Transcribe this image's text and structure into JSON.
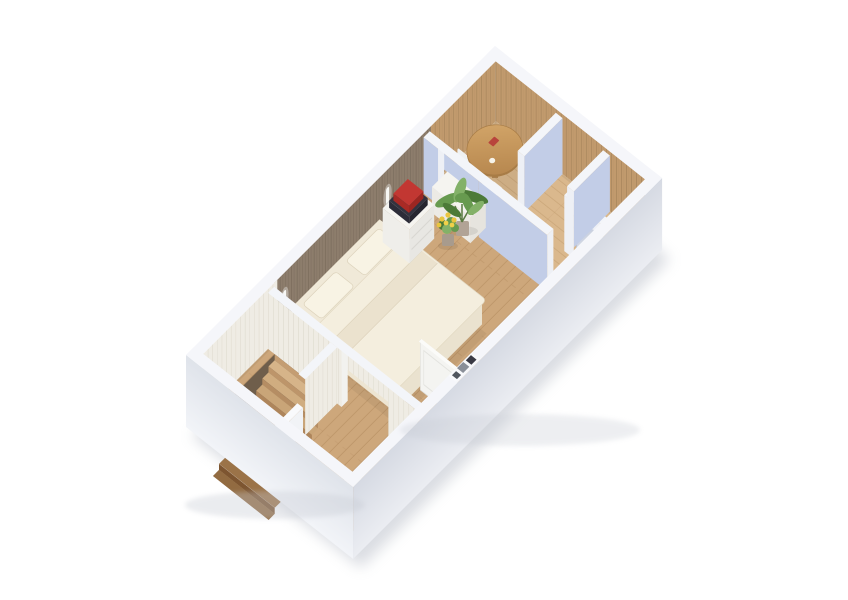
{
  "scene": {
    "type": "isometric-3d-floor-plan",
    "style": "dollhouse cutaway architectural render on white background",
    "rooms": [
      {
        "id": "bedroom",
        "label": "Bedroom",
        "floor": "light oak plank flooring",
        "accent_wall": "brown wood paneling"
      },
      {
        "id": "dining-nook",
        "label": "Dining nook",
        "floor": "oak plank flooring",
        "accent_wall": "natural oak vertical paneling"
      },
      {
        "id": "hallway",
        "label": "Hallway / entry",
        "floor": "diagonal oak planks"
      },
      {
        "id": "stair-hall",
        "label": "Stair hall",
        "floor": "oak plank flooring"
      }
    ],
    "furniture": [
      {
        "id": "double-bed",
        "label": "Double bed with cream duvet, folded throw and two pillows",
        "room": "bedroom"
      },
      {
        "id": "dresser",
        "label": "White bedside dresser with stacked red and dark books on top",
        "room": "bedroom"
      },
      {
        "id": "nightstand",
        "label": "White nightstand",
        "room": "bedroom"
      },
      {
        "id": "wall-sconces",
        "label": "Two white wall sconces on brown paneled wall",
        "room": "bedroom"
      },
      {
        "id": "plant-tall",
        "label": "Tall green potted plant",
        "room": "bedroom"
      },
      {
        "id": "plant-yellow",
        "label": "Small potted plant with yellow flowers",
        "room": "bedroom"
      },
      {
        "id": "round-table",
        "label": "Round wooden dining table with two chairs",
        "room": "dining-nook"
      },
      {
        "id": "service-counter",
        "label": "White counter in pass-through opening",
        "room": "dining-nook"
      },
      {
        "id": "staircase",
        "label": "Wooden staircase descending below",
        "room": "stair-hall"
      },
      {
        "id": "stair-railing",
        "label": "White stair railing and cream knee wall",
        "room": "stair-hall"
      },
      {
        "id": "open-door",
        "label": "Open white interior door",
        "room": "bedroom"
      },
      {
        "id": "blue-door",
        "label": "Blue-grey interior door in white partition",
        "room": "hallway"
      },
      {
        "id": "wall-top-decor",
        "label": "Small dark objects resting on cut wall top",
        "room": "bedroom"
      }
    ],
    "walls": {
      "exterior": "white cutaway walls",
      "partitions": "light periwinkle-blue walls with white caps",
      "stairwell": "cream vertical paneling"
    }
  },
  "colors": {
    "bg": "#ffffff",
    "shadow": "#aeb4c0",
    "ext_top": "#f5f6fa",
    "ext_sw_light": "#f2f4f8",
    "ext_sw_dark": "#dfe3ea",
    "ext_se_light": "#ebedf2",
    "ext_se_dark": "#d6dae3",
    "oak_base": "#c19a6d",
    "oak_line": "#a6845b",
    "brown_base": "#8d7d6c",
    "brown_line": "#796b5b",
    "cream_base": "#efece4",
    "cream_line": "#dfdbcf",
    "floor_base": "#cda77b",
    "floor_line": "#b1895c",
    "hall_base": "#dab88d",
    "hall_line": "#c09c6e",
    "blue_wall": "#c2cde7",
    "white_face": "#eef0f5",
    "cap": "#f3f5f9",
    "void": "#6f5e4b",
    "bed_side": "#eae2cf",
    "bed_top": "#f0e9d8",
    "duvet": "#f4eede",
    "pillow": "#f8f3e4",
    "throw": "#ebe2ce",
    "furn_top": "#f5f4f0",
    "furn_front": "#e8e7e3",
    "furn_side": "#efeeea",
    "book_dark": "#33333f",
    "book_red": "#c23732",
    "table_wood": "#cb9c60",
    "table_wood_dark": "#b2824a",
    "chair_red": "#c4524a",
    "green": "#679a4f",
    "green_dark": "#4c7a38",
    "green_light": "#83b168",
    "yellow": "#e9c53e",
    "pot": "#b1a396",
    "door_white": "#f4f4f1",
    "door_blue": "#c7cedd"
  }
}
